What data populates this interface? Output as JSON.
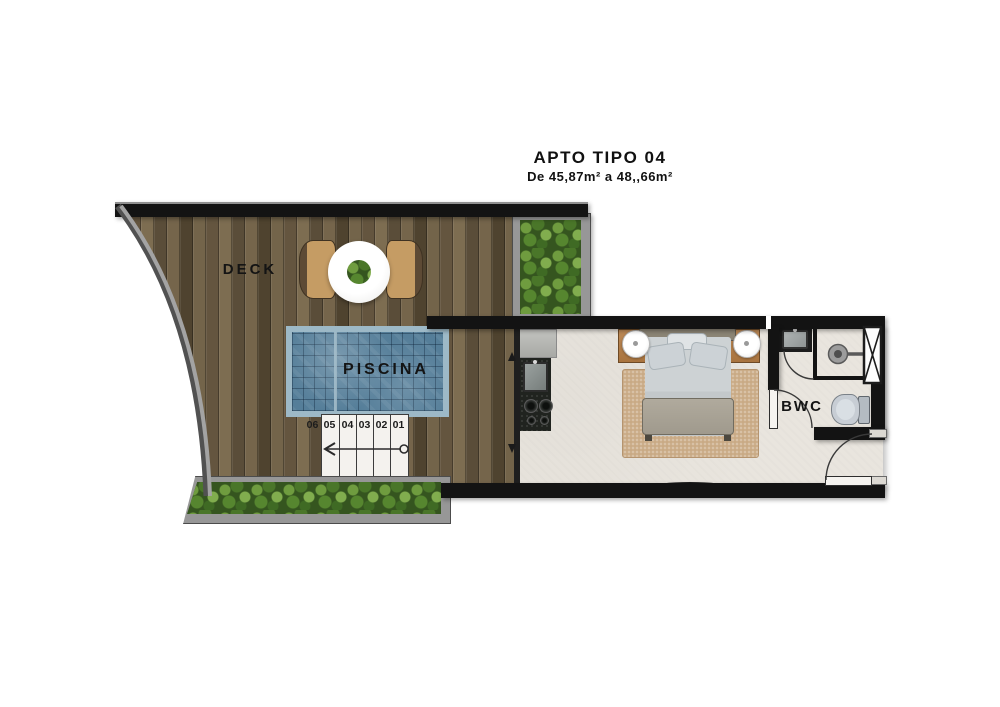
{
  "header": {
    "title": "APTO TIPO 04",
    "subtitle": "De 45,87m² a 48,,66m²"
  },
  "rooms": {
    "deck_label": "DECK",
    "pool_label": "PISCINA",
    "bathroom_label": "BWC"
  },
  "stairs": {
    "numbers": [
      "06",
      "05",
      "04",
      "03",
      "02",
      "01"
    ]
  },
  "colors": {
    "wall": "#131313",
    "floor": "#e9e5de",
    "wood_base": "#6f6048",
    "pool": "#557e99",
    "pool_border": "#9db9c7",
    "foliage": "#35551f",
    "frame": "#979797",
    "furn_wood": "#bd8a57",
    "rug": "#c9aa85",
    "fixture": "#c7cdd4",
    "ink": "#141414"
  }
}
